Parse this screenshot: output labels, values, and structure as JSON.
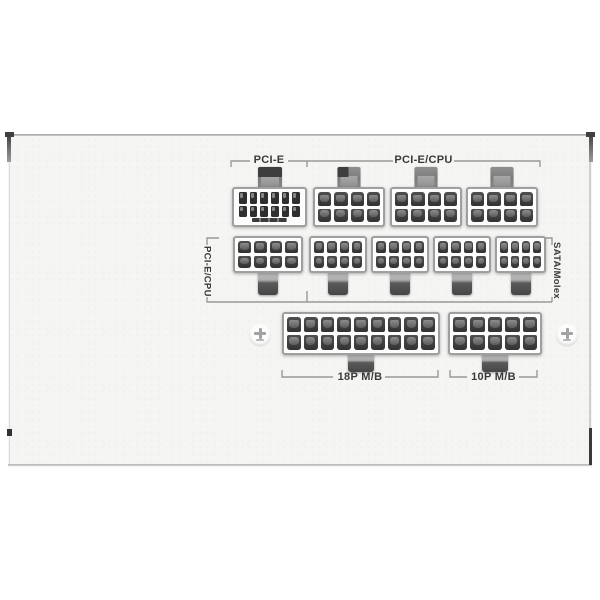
{
  "labels": {
    "top_bracket_left": "PCI-E",
    "top_bracket_right": "PCI-E/CPU",
    "side_left_vertical": "PCI-E/CPU",
    "side_right_vertical": "SATA/Molex",
    "bottom_bracket_18p": "18P M/B",
    "bottom_bracket_10p": "10P M/B"
  },
  "colors": {
    "page_background": "#ffffff",
    "panel_face": "#f5f5f3",
    "bracket_line": "#9a9a9a",
    "label_text": "#3a3a3a",
    "connector_body": "#fcfcfc",
    "connector_border": "#9f9f9f",
    "pin_socket_dark": "#383838",
    "latch_gray": "#7c7c7c"
  },
  "connectors": {
    "items": [
      {
        "id": "pcie-12pin-socket",
        "group": "PCI-E",
        "pin_count": 12,
        "rows": 2,
        "cols": 6,
        "x": 232,
        "y": 187,
        "w": 75,
        "h": 40,
        "tab": "top",
        "tab_w": 24,
        "tab_h": 21,
        "variant": "cap",
        "small": true,
        "slot": true
      },
      {
        "id": "pcie-cpu-8pin-socket-1",
        "group": "PCI-E/CPU",
        "pin_count": 8,
        "rows": 2,
        "cols": 4,
        "x": 313,
        "y": 187,
        "w": 72,
        "h": 40,
        "tab": "top",
        "tab_w": 23,
        "tab_h": 21,
        "variant": "corner"
      },
      {
        "id": "pcie-cpu-8pin-socket-2",
        "group": "PCI-E/CPU",
        "pin_count": 8,
        "rows": 2,
        "cols": 4,
        "x": 390,
        "y": 187,
        "w": 72,
        "h": 40,
        "tab": "top",
        "tab_w": 23,
        "tab_h": 21
      },
      {
        "id": "pcie-cpu-8pin-socket-3",
        "group": "PCI-E/CPU",
        "pin_count": 8,
        "rows": 2,
        "cols": 4,
        "x": 466,
        "y": 187,
        "w": 72,
        "h": 40,
        "tab": "top",
        "tab_w": 23,
        "tab_h": 21
      },
      {
        "id": "pcie-cpu-8pin-socket-4",
        "group": "PCI-E/CPU",
        "pin_count": 8,
        "rows": 2,
        "cols": 4,
        "x": 233,
        "y": 236,
        "w": 70,
        "h": 37,
        "tab": "bottom",
        "tab_w": 20,
        "tab_h": 23
      },
      {
        "id": "sata-molex-8pin-socket-1",
        "group": "SATA/Molex",
        "pin_count": 8,
        "rows": 2,
        "cols": 4,
        "x": 309,
        "y": 236,
        "w": 58,
        "h": 37,
        "tab": "bottom",
        "tab_w": 20,
        "tab_h": 23
      },
      {
        "id": "sata-molex-8pin-socket-2",
        "group": "SATA/Molex",
        "pin_count": 8,
        "rows": 2,
        "cols": 4,
        "x": 371,
        "y": 236,
        "w": 58,
        "h": 37,
        "tab": "bottom",
        "tab_w": 20,
        "tab_h": 23
      },
      {
        "id": "sata-molex-8pin-socket-3",
        "group": "SATA/Molex",
        "pin_count": 8,
        "rows": 2,
        "cols": 4,
        "x": 433,
        "y": 236,
        "w": 58,
        "h": 37,
        "tab": "bottom",
        "tab_w": 20,
        "tab_h": 23
      },
      {
        "id": "sata-molex-8pin-socket-4",
        "group": "SATA/Molex",
        "pin_count": 8,
        "rows": 2,
        "cols": 4,
        "x": 495,
        "y": 236,
        "w": 51,
        "h": 37,
        "tab": "bottom",
        "tab_w": 20,
        "tab_h": 23
      },
      {
        "id": "mb-18p-socket",
        "group": "18P M/B",
        "pin_count": 18,
        "rows": 2,
        "cols": 9,
        "x": 282,
        "y": 312,
        "w": 158,
        "h": 43,
        "tab": "bottom",
        "tab_w": 26,
        "tab_h": 18
      },
      {
        "id": "mb-10p-socket",
        "group": "10P M/B",
        "pin_count": 10,
        "rows": 2,
        "cols": 5,
        "x": 448,
        "y": 312,
        "w": 94,
        "h": 43,
        "tab": "bottom",
        "tab_w": 26,
        "tab_h": 18
      }
    ]
  },
  "screws": [
    {
      "id": "screw-hole-left",
      "x": 249,
      "y": 324
    },
    {
      "id": "screw-hole-right",
      "x": 556,
      "y": 324
    }
  ]
}
